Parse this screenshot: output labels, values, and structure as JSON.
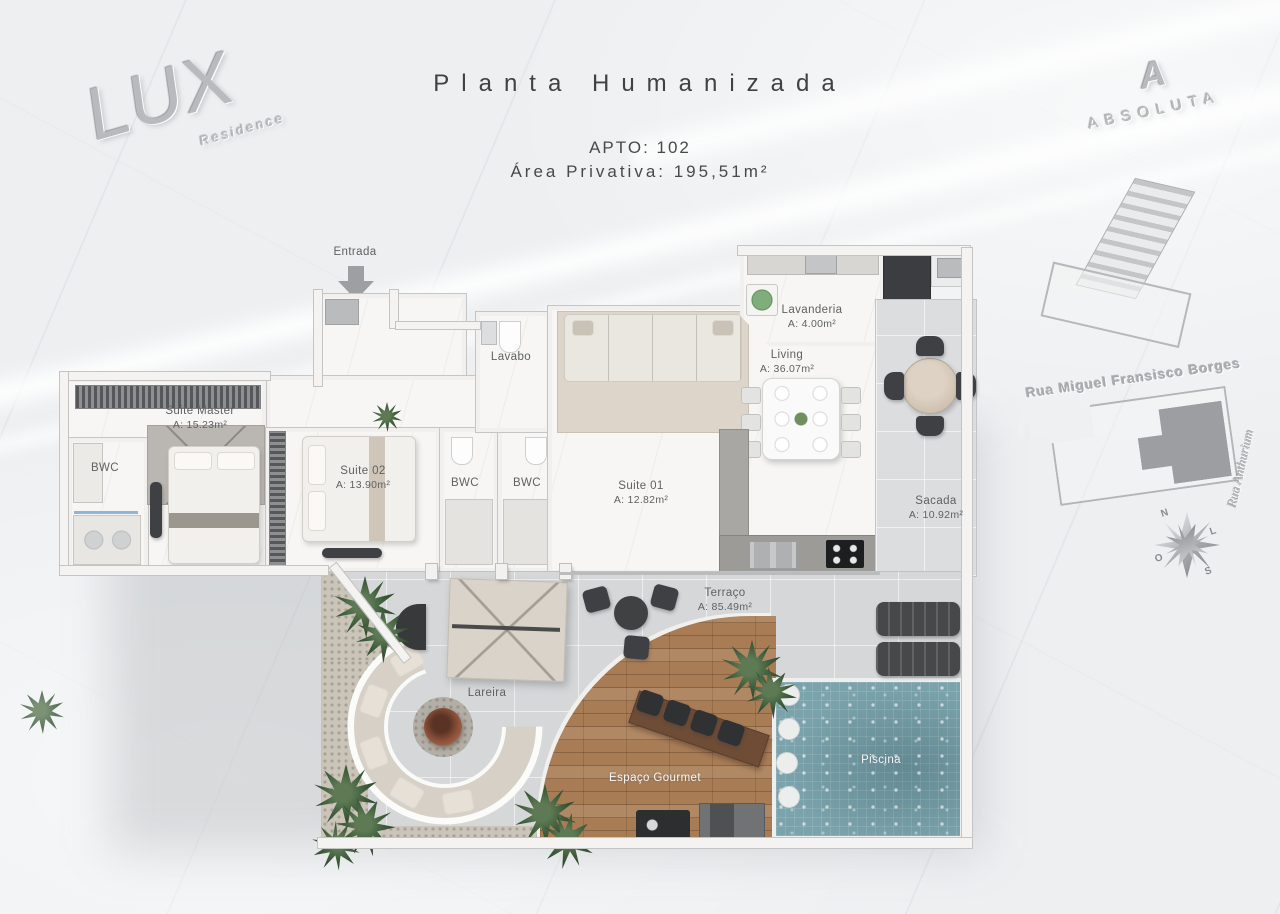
{
  "header": {
    "title": "Planta Humanizada",
    "apto": "APTO: 102",
    "area_privativa": "Área Privativa:  195,51m²"
  },
  "branding": {
    "lux_name": "LUX",
    "lux_tagline": "Residence",
    "absoluta_mark": "A",
    "absoluta_name": "ABSOLUTA"
  },
  "entrance": {
    "label": "Entrada"
  },
  "rooms": {
    "suite_master": {
      "name": "Suite Master",
      "area": "A: 15.23m²"
    },
    "bwc_master": {
      "name": "BWC"
    },
    "suite_02": {
      "name": "Suite 02",
      "area": "A: 13.90m²"
    },
    "bwc_1": {
      "name": "BWC"
    },
    "bwc_2": {
      "name": "BWC"
    },
    "suite_01": {
      "name": "Suite 01",
      "area": "A: 12.82m²"
    },
    "lavabo": {
      "name": "Lavabo"
    },
    "lavanderia": {
      "name": "Lavanderia",
      "area": "A: 4.00m²"
    },
    "living": {
      "name": "Living",
      "area": "A: 36.07m²"
    },
    "sacada": {
      "name": "Sacada",
      "area": "A: 10.92m²"
    },
    "terraco": {
      "name": "Terraço",
      "area": "A: 85.49m²"
    },
    "lareira": {
      "name": "Lareira"
    },
    "espaco_gourmet": {
      "name": "Espaço Gourmet"
    },
    "piscina": {
      "name": "Piscina"
    }
  },
  "site_plan": {
    "street_main": "Rua Miguel Fransisco Borges",
    "street_side": "Rua Anthurium"
  },
  "compass": {
    "north": "N",
    "east": "L",
    "south": "S",
    "west": "O"
  },
  "colors": {
    "wood_deck": "#a87c55",
    "pool_water": "#7ba3ac",
    "dark_furniture": "#3e4043",
    "label_text": "#5f6163",
    "marble_floor": "#f6f5f3",
    "terrace_tile": "#d5d7d8"
  }
}
